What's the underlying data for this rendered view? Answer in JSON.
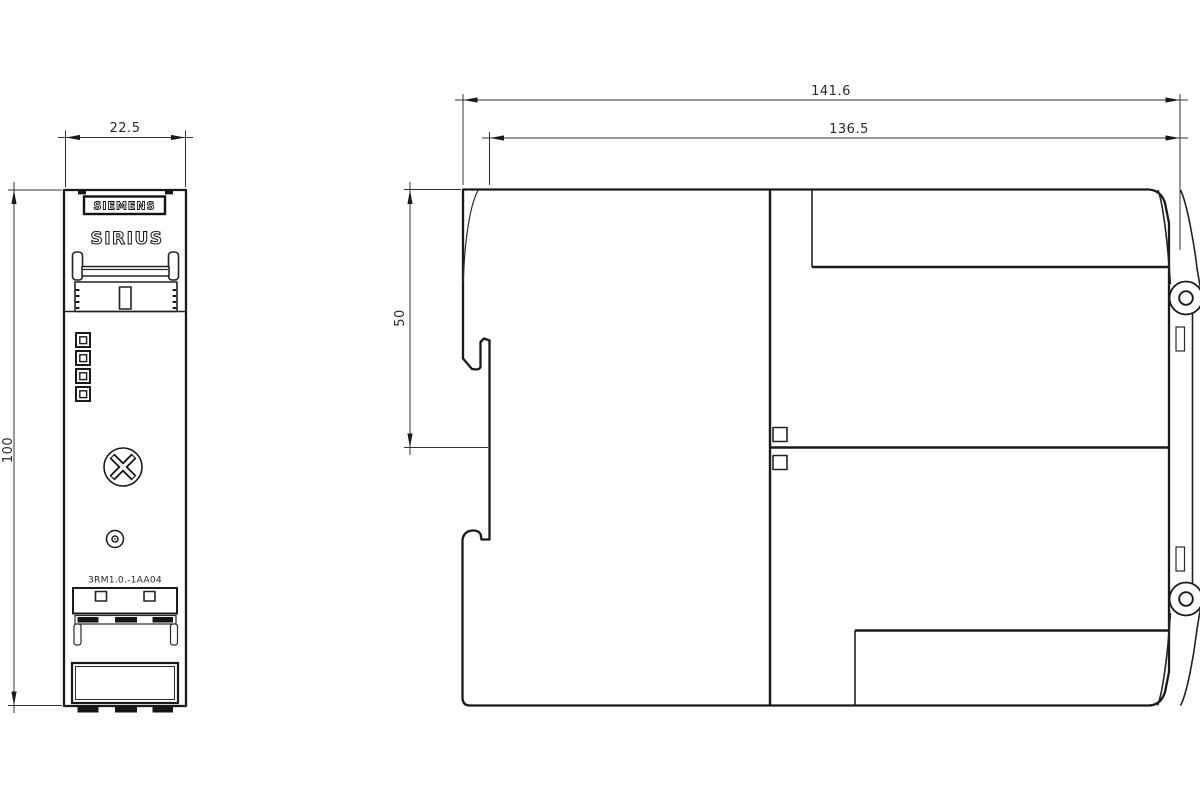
{
  "drawing": {
    "front_view": {
      "brand": "SIEMENS",
      "product_line": "SIRIUS",
      "model": "3RM1.0.-1AA04",
      "dim_width": "22.5",
      "dim_height": "100"
    },
    "side_view": {
      "dim_total_width": "141.6",
      "dim_body_width": "136.5",
      "dim_rail_section": "50"
    },
    "colors": {
      "ink": "#222222",
      "background": "#ffffff"
    }
  }
}
